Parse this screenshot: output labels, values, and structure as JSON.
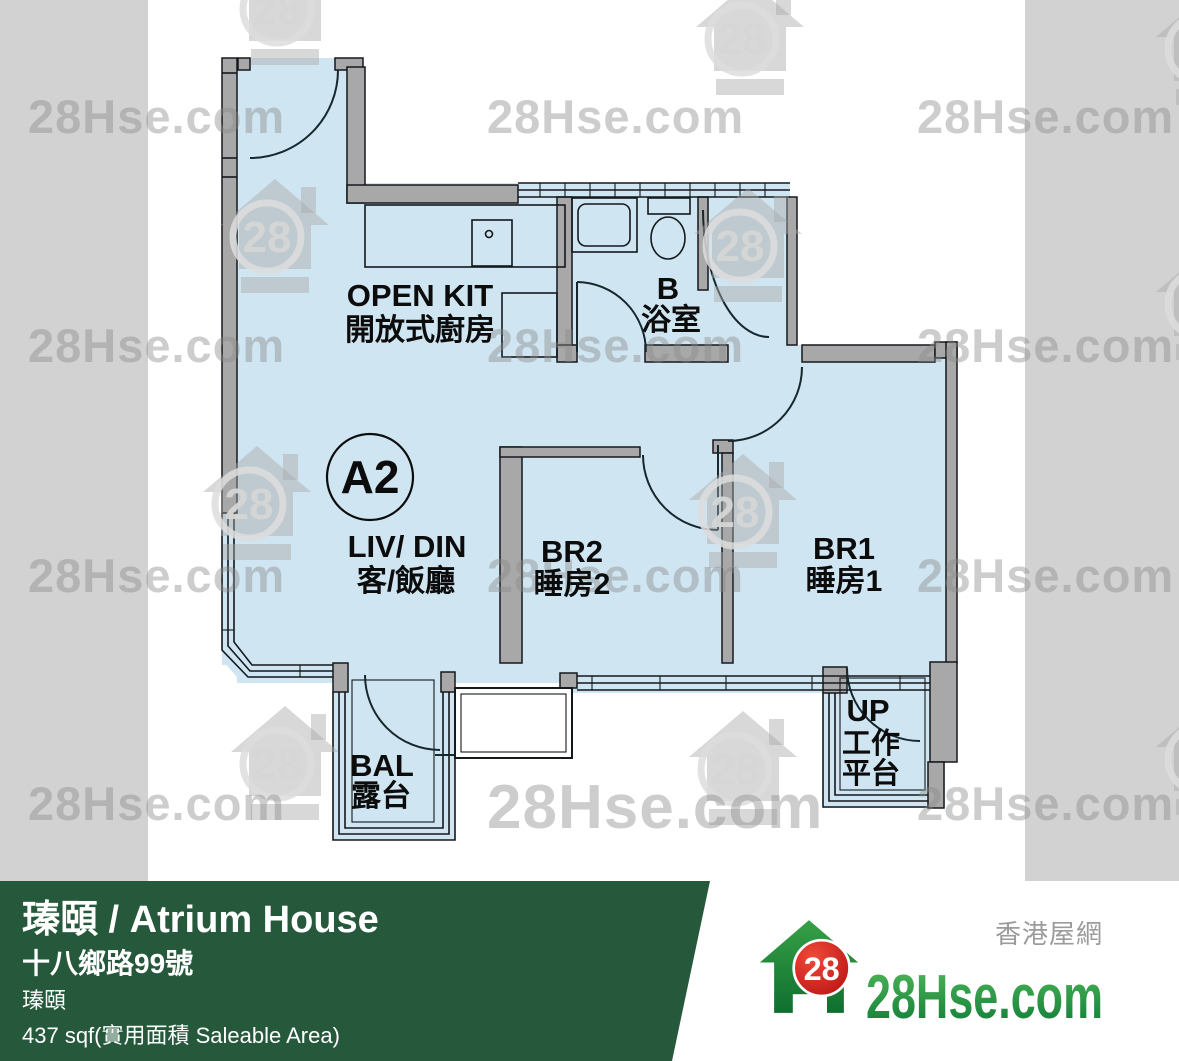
{
  "watermark": {
    "text": "28Hse.com",
    "badge": "28"
  },
  "plan": {
    "unit_label": "A2",
    "rooms": {
      "kitchen": {
        "en": "OPEN KIT",
        "zh": "開放式廚房"
      },
      "bathroom": {
        "en": "B",
        "zh": "浴室"
      },
      "living": {
        "en": "LIV/ DIN",
        "zh": "客/飯廳"
      },
      "bedroom2": {
        "en": "BR2",
        "zh": "睡房2"
      },
      "bedroom1": {
        "en": "BR1",
        "zh": "睡房1"
      },
      "balcony": {
        "en": "BAL",
        "zh": "露台"
      },
      "utility": {
        "en": "UP",
        "zh_line1": "工作",
        "zh_line2": "平台"
      }
    },
    "colors": {
      "floor": "#cfe5f1",
      "wall": "#a8a8a8",
      "line": "#15181c",
      "side_strip": "#d2d2d2"
    }
  },
  "info_bar": {
    "title": "瑧頤 / Atrium House",
    "address": "十八鄉路99號",
    "estate": "瑧頤",
    "area": "437 sqf(實用面積 Saleable Area)",
    "bg": "#26593c"
  },
  "logo": {
    "tagline_zh": "香港屋網",
    "brand": "28Hse.com",
    "badge": "28",
    "green_dark": "#0c7a36",
    "green_light": "#52b85a",
    "red": "#d42020"
  }
}
